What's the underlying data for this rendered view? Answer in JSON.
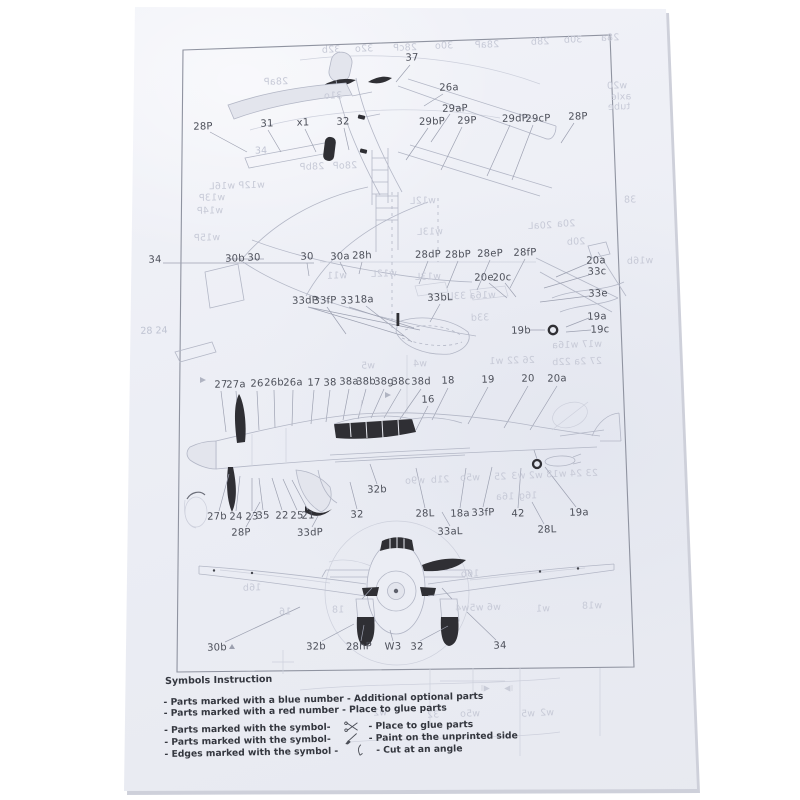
{
  "colors": {
    "paper": "#ebedf4",
    "ink_dark": "#2f2f34",
    "line_light": "#b3b7c6",
    "label_ink": "#4c4f59",
    "bleedthrough": "#c7cad7"
  },
  "legend": {
    "title": "Symbols Instruction",
    "items": [
      {
        "left": "- Parts marked with a blue number - Additional optional parts",
        "symbol": "",
        "right": ""
      },
      {
        "left": "- Parts marked with a red number - Place to glue parts",
        "symbol": "",
        "right": ""
      },
      {
        "left": "- Parts marked with the symbol-",
        "symbol": "scissors",
        "right": "- Place to glue parts"
      },
      {
        "left": "- Parts marked with the symbol-",
        "symbol": "brush",
        "right": "- Paint on the unprinted side"
      },
      {
        "left": "- Edges marked with the symbol -",
        "symbol": "knife",
        "right": "- Cut at an angle"
      }
    ]
  },
  "part_labels": [
    {
      "t": "37",
      "x": 412,
      "y": 58
    },
    {
      "t": "26a",
      "x": 449,
      "y": 88
    },
    {
      "t": "29aP",
      "x": 455,
      "y": 109
    },
    {
      "t": "29bP",
      "x": 432,
      "y": 122
    },
    {
      "t": "29P",
      "x": 467,
      "y": 121
    },
    {
      "t": "29dP",
      "x": 515,
      "y": 119
    },
    {
      "t": "29cP",
      "x": 538,
      "y": 119
    },
    {
      "t": "28P",
      "x": 578,
      "y": 117
    },
    {
      "t": "28P",
      "x": 203,
      "y": 127
    },
    {
      "t": "31",
      "x": 267,
      "y": 124
    },
    {
      "t": "x1",
      "x": 303,
      "y": 123
    },
    {
      "t": "32",
      "x": 343,
      "y": 122
    },
    {
      "t": "34",
      "x": 155,
      "y": 260
    },
    {
      "t": "30b",
      "x": 235,
      "y": 259
    },
    {
      "t": "30",
      "x": 254,
      "y": 258
    },
    {
      "t": "30",
      "x": 307,
      "y": 257
    },
    {
      "t": "30a",
      "x": 340,
      "y": 257
    },
    {
      "t": "28h",
      "x": 362,
      "y": 256
    },
    {
      "t": "28dP",
      "x": 428,
      "y": 255
    },
    {
      "t": "28bP",
      "x": 458,
      "y": 255
    },
    {
      "t": "28eP",
      "x": 490,
      "y": 254
    },
    {
      "t": "28fP",
      "x": 525,
      "y": 253
    },
    {
      "t": "20a",
      "x": 596,
      "y": 261
    },
    {
      "t": "33c",
      "x": 597,
      "y": 272
    },
    {
      "t": "33e",
      "x": 598,
      "y": 294
    },
    {
      "t": "19a",
      "x": 597,
      "y": 317
    },
    {
      "t": "19c",
      "x": 600,
      "y": 330
    },
    {
      "t": "19b",
      "x": 521,
      "y": 331
    },
    {
      "t": "20e",
      "x": 484,
      "y": 278
    },
    {
      "t": "20c",
      "x": 502,
      "y": 278
    },
    {
      "t": "33dP",
      "x": 305,
      "y": 301
    },
    {
      "t": "33fP",
      "x": 325,
      "y": 301
    },
    {
      "t": "33",
      "x": 347,
      "y": 301
    },
    {
      "t": "18a",
      "x": 364,
      "y": 300
    },
    {
      "t": "33bL",
      "x": 440,
      "y": 298
    },
    {
      "t": "27",
      "x": 221,
      "y": 385
    },
    {
      "t": "27a",
      "x": 236,
      "y": 385
    },
    {
      "t": "26",
      "x": 257,
      "y": 384
    },
    {
      "t": "26b",
      "x": 274,
      "y": 383
    },
    {
      "t": "26a",
      "x": 293,
      "y": 383
    },
    {
      "t": "17",
      "x": 314,
      "y": 383
    },
    {
      "t": "38",
      "x": 330,
      "y": 383
    },
    {
      "t": "38a",
      "x": 349,
      "y": 382
    },
    {
      "t": "38b",
      "x": 366,
      "y": 382
    },
    {
      "t": "38g",
      "x": 384,
      "y": 382
    },
    {
      "t": "38c",
      "x": 401,
      "y": 382
    },
    {
      "t": "38d",
      "x": 421,
      "y": 382
    },
    {
      "t": "18",
      "x": 448,
      "y": 381
    },
    {
      "t": "19",
      "x": 488,
      "y": 380
    },
    {
      "t": "20",
      "x": 528,
      "y": 379
    },
    {
      "t": "20a",
      "x": 557,
      "y": 379
    },
    {
      "t": "16",
      "x": 428,
      "y": 400
    },
    {
      "t": "32b",
      "x": 377,
      "y": 490
    },
    {
      "t": "27b",
      "x": 217,
      "y": 517
    },
    {
      "t": "24",
      "x": 236,
      "y": 517
    },
    {
      "t": "23",
      "x": 252,
      "y": 517
    },
    {
      "t": "35",
      "x": 263,
      "y": 516
    },
    {
      "t": "22",
      "x": 282,
      "y": 516
    },
    {
      "t": "25",
      "x": 297,
      "y": 516
    },
    {
      "t": "21",
      "x": 308,
      "y": 516
    },
    {
      "t": "32",
      "x": 357,
      "y": 515
    },
    {
      "t": "28L",
      "x": 425,
      "y": 514
    },
    {
      "t": "18a",
      "x": 460,
      "y": 514
    },
    {
      "t": "33fP",
      "x": 483,
      "y": 513
    },
    {
      "t": "42",
      "x": 518,
      "y": 514
    },
    {
      "t": "19a",
      "x": 579,
      "y": 513
    },
    {
      "t": "28P",
      "x": 241,
      "y": 533
    },
    {
      "t": "33dP",
      "x": 310,
      "y": 533
    },
    {
      "t": "33aL",
      "x": 450,
      "y": 532
    },
    {
      "t": "28L",
      "x": 547,
      "y": 530
    },
    {
      "t": "30b",
      "x": 217,
      "y": 648
    },
    {
      "t": "32b",
      "x": 316,
      "y": 647
    },
    {
      "t": "28hP",
      "x": 359,
      "y": 647
    },
    {
      "t": "W3",
      "x": 393,
      "y": 647
    },
    {
      "t": "32",
      "x": 417,
      "y": 647
    },
    {
      "t": "34",
      "x": 500,
      "y": 646
    }
  ],
  "bleedthrough_labels": [
    {
      "t": "32b",
      "x": 331,
      "y": 50
    },
    {
      "t": "32o",
      "x": 364,
      "y": 49
    },
    {
      "t": "28cP",
      "x": 405,
      "y": 48
    },
    {
      "t": "30o",
      "x": 444,
      "y": 46
    },
    {
      "t": "28aP",
      "x": 487,
      "y": 45
    },
    {
      "t": "28b",
      "x": 540,
      "y": 42
    },
    {
      "t": "30b",
      "x": 573,
      "y": 40
    },
    {
      "t": "28a",
      "x": 610,
      "y": 38
    },
    {
      "t": "28aP",
      "x": 276,
      "y": 82
    },
    {
      "t": "31o",
      "x": 333,
      "y": 96
    },
    {
      "t": "w20",
      "x": 617,
      "y": 86
    },
    {
      "t": "axle",
      "x": 621,
      "y": 97
    },
    {
      "t": "tube",
      "x": 619,
      "y": 107
    },
    {
      "t": "28bP",
      "x": 312,
      "y": 167
    },
    {
      "t": "28oP",
      "x": 345,
      "y": 166
    },
    {
      "t": "w12P w16L",
      "x": 237,
      "y": 186
    },
    {
      "t": "w13P",
      "x": 212,
      "y": 198
    },
    {
      "t": "w14P",
      "x": 210,
      "y": 211
    },
    {
      "t": "w15P",
      "x": 207,
      "y": 238
    },
    {
      "t": "w12L",
      "x": 423,
      "y": 201
    },
    {
      "t": "w13L",
      "x": 430,
      "y": 232
    },
    {
      "t": "38",
      "x": 630,
      "y": 200
    },
    {
      "t": "20aL",
      "x": 540,
      "y": 226
    },
    {
      "t": "20a",
      "x": 566,
      "y": 224
    },
    {
      "t": "20b",
      "x": 576,
      "y": 242
    },
    {
      "t": "w16b",
      "x": 640,
      "y": 261
    },
    {
      "t": "w11",
      "x": 337,
      "y": 276
    },
    {
      "t": "w12L",
      "x": 384,
      "y": 274
    },
    {
      "t": "w13L",
      "x": 428,
      "y": 277
    },
    {
      "t": "w16a 33L",
      "x": 472,
      "y": 296
    },
    {
      "t": "33d",
      "x": 480,
      "y": 318
    },
    {
      "t": "w17 w16a",
      "x": 577,
      "y": 345
    },
    {
      "t": "27 2a 22b",
      "x": 577,
      "y": 362
    },
    {
      "t": "w5",
      "x": 368,
      "y": 366
    },
    {
      "t": "w4",
      "x": 420,
      "y": 364
    },
    {
      "t": "26 22 w1",
      "x": 512,
      "y": 361
    },
    {
      "t": "w9o",
      "x": 415,
      "y": 481
    },
    {
      "t": "21b",
      "x": 440,
      "y": 480
    },
    {
      "t": "w5o",
      "x": 470,
      "y": 478
    },
    {
      "t": "25",
      "x": 500,
      "y": 477
    },
    {
      "t": "w2 w3",
      "x": 527,
      "y": 476
    },
    {
      "t": "23 24 w18",
      "x": 572,
      "y": 474
    },
    {
      "t": "16a",
      "x": 505,
      "y": 497
    },
    {
      "t": "16g",
      "x": 528,
      "y": 496
    },
    {
      "t": "16b",
      "x": 252,
      "y": 588
    },
    {
      "t": "16b",
      "x": 470,
      "y": 574
    },
    {
      "t": "16",
      "x": 285,
      "y": 612
    },
    {
      "t": "18",
      "x": 338,
      "y": 610
    },
    {
      "t": "w6 w5w4",
      "x": 478,
      "y": 608
    },
    {
      "t": "w1",
      "x": 543,
      "y": 609
    },
    {
      "t": "w18",
      "x": 592,
      "y": 606
    },
    {
      "t": "w2",
      "x": 380,
      "y": 713
    },
    {
      "t": "32",
      "x": 433,
      "y": 715
    },
    {
      "t": "w5o",
      "x": 470,
      "y": 714
    },
    {
      "t": "w5",
      "x": 528,
      "y": 714
    },
    {
      "t": "w2",
      "x": 547,
      "y": 713
    }
  ],
  "ghost_labels": [
    {
      "t": "28  24",
      "x": 154,
      "y": 331
    },
    {
      "t": "34",
      "x": 261,
      "y": 151
    }
  ]
}
